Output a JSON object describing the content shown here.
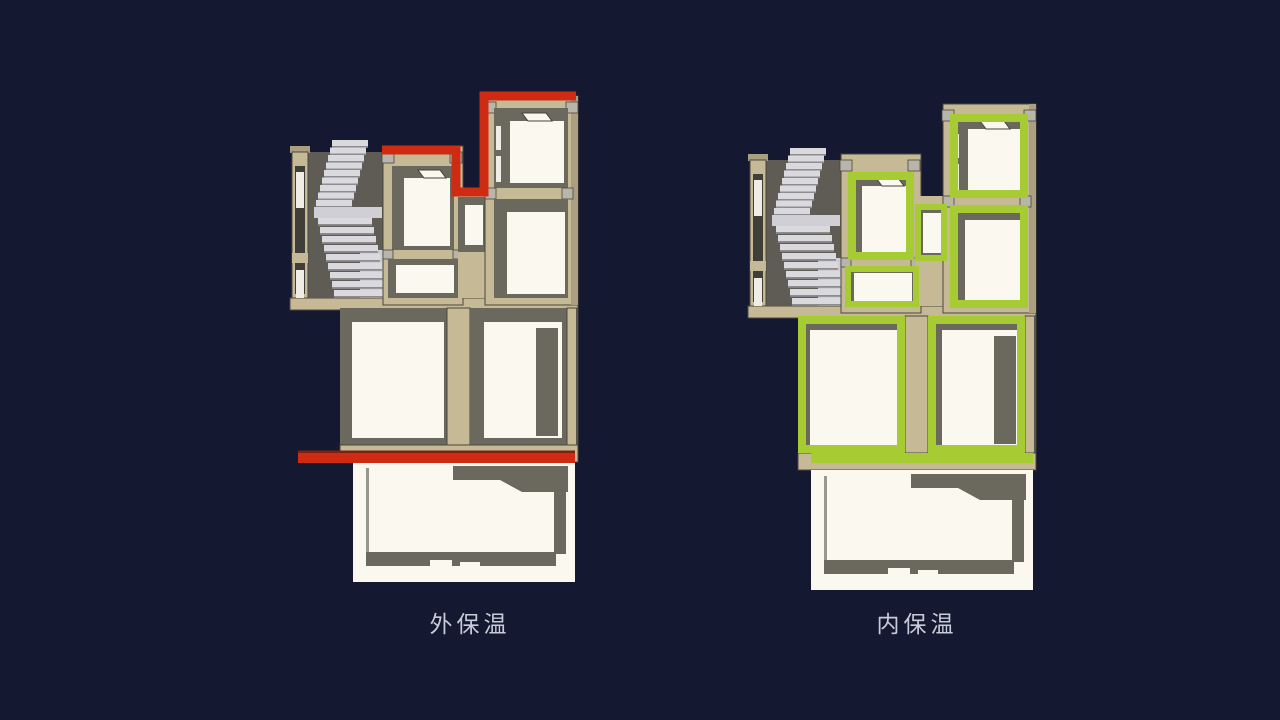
{
  "slide": {
    "background_color": "#151831",
    "label_color": "#c7ccd9"
  },
  "diagrams": [
    {
      "id": "external-insulation",
      "label": "外保温",
      "highlight_color": "#cf2b12",
      "highlight_location": "roofline-and-floor-band"
    },
    {
      "id": "internal-insulation",
      "label": "内保温",
      "highlight_color": "#a6cb33",
      "highlight_location": "room-linings-and-floor-band"
    }
  ],
  "palette": {
    "wall_cut": "#c6b995",
    "wall_cut_shade": "#ab9f82",
    "interior_shadow": "#6b695e",
    "room_face": "#fbf8f0",
    "stairs": "#dad9de",
    "outline": "#4a463c"
  }
}
